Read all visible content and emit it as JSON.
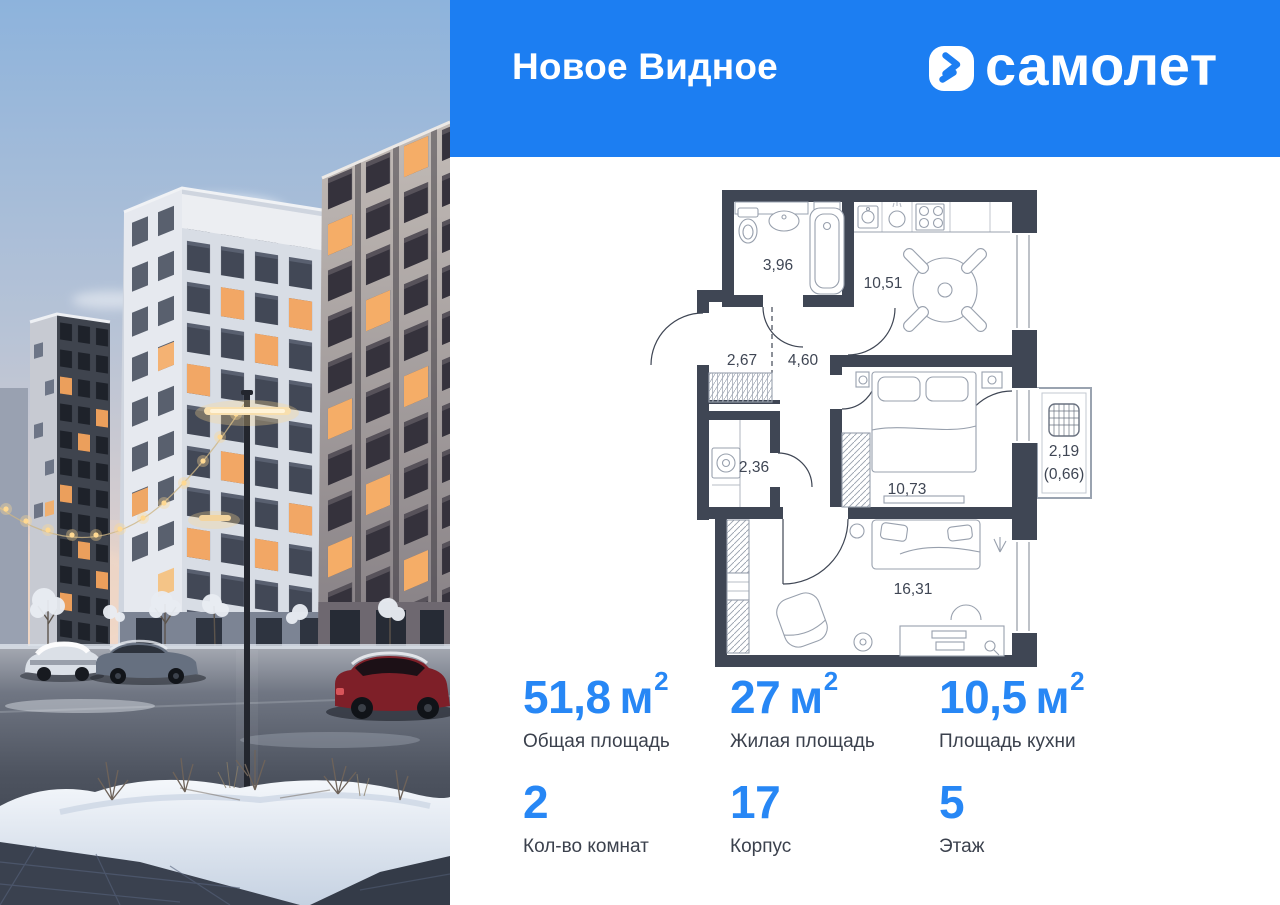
{
  "header": {
    "project_name": "Новое Видное",
    "brand_name": "самолет"
  },
  "floorplan": {
    "rooms": [
      {
        "name": "bathroom",
        "area": "3,96"
      },
      {
        "name": "kitchen",
        "area": "10,51"
      },
      {
        "name": "hallway",
        "area": "2,67"
      },
      {
        "name": "corridor",
        "area": "4,60"
      },
      {
        "name": "storage",
        "area": "2,36"
      },
      {
        "name": "bedroom",
        "area": "10,73"
      },
      {
        "name": "living-room",
        "area": "16,31"
      },
      {
        "name": "balcony",
        "area": "2,19",
        "area_secondary": "(0,66)"
      }
    ]
  },
  "stats": {
    "rows": [
      [
        {
          "value": "51,8",
          "unit": "м",
          "sup": "2",
          "label": "Общая площадь"
        },
        {
          "value": "27",
          "unit": "м",
          "sup": "2",
          "label": "Жилая площадь"
        },
        {
          "value": "10,5",
          "unit": "м",
          "sup": "2",
          "label": "Площадь кухни"
        }
      ],
      [
        {
          "value": "2",
          "label": "Кол-во комнат"
        },
        {
          "value": "17",
          "label": "Корпус"
        },
        {
          "value": "5",
          "label": "Этаж"
        }
      ]
    ]
  },
  "photo": {
    "alt": "Winter evening view of residential buildings with parked cars and snow"
  },
  "colors": {
    "header_bg": "#1c7ef2",
    "accent": "#2787f5",
    "wall": "#3f4654",
    "label": "#3b414d"
  }
}
